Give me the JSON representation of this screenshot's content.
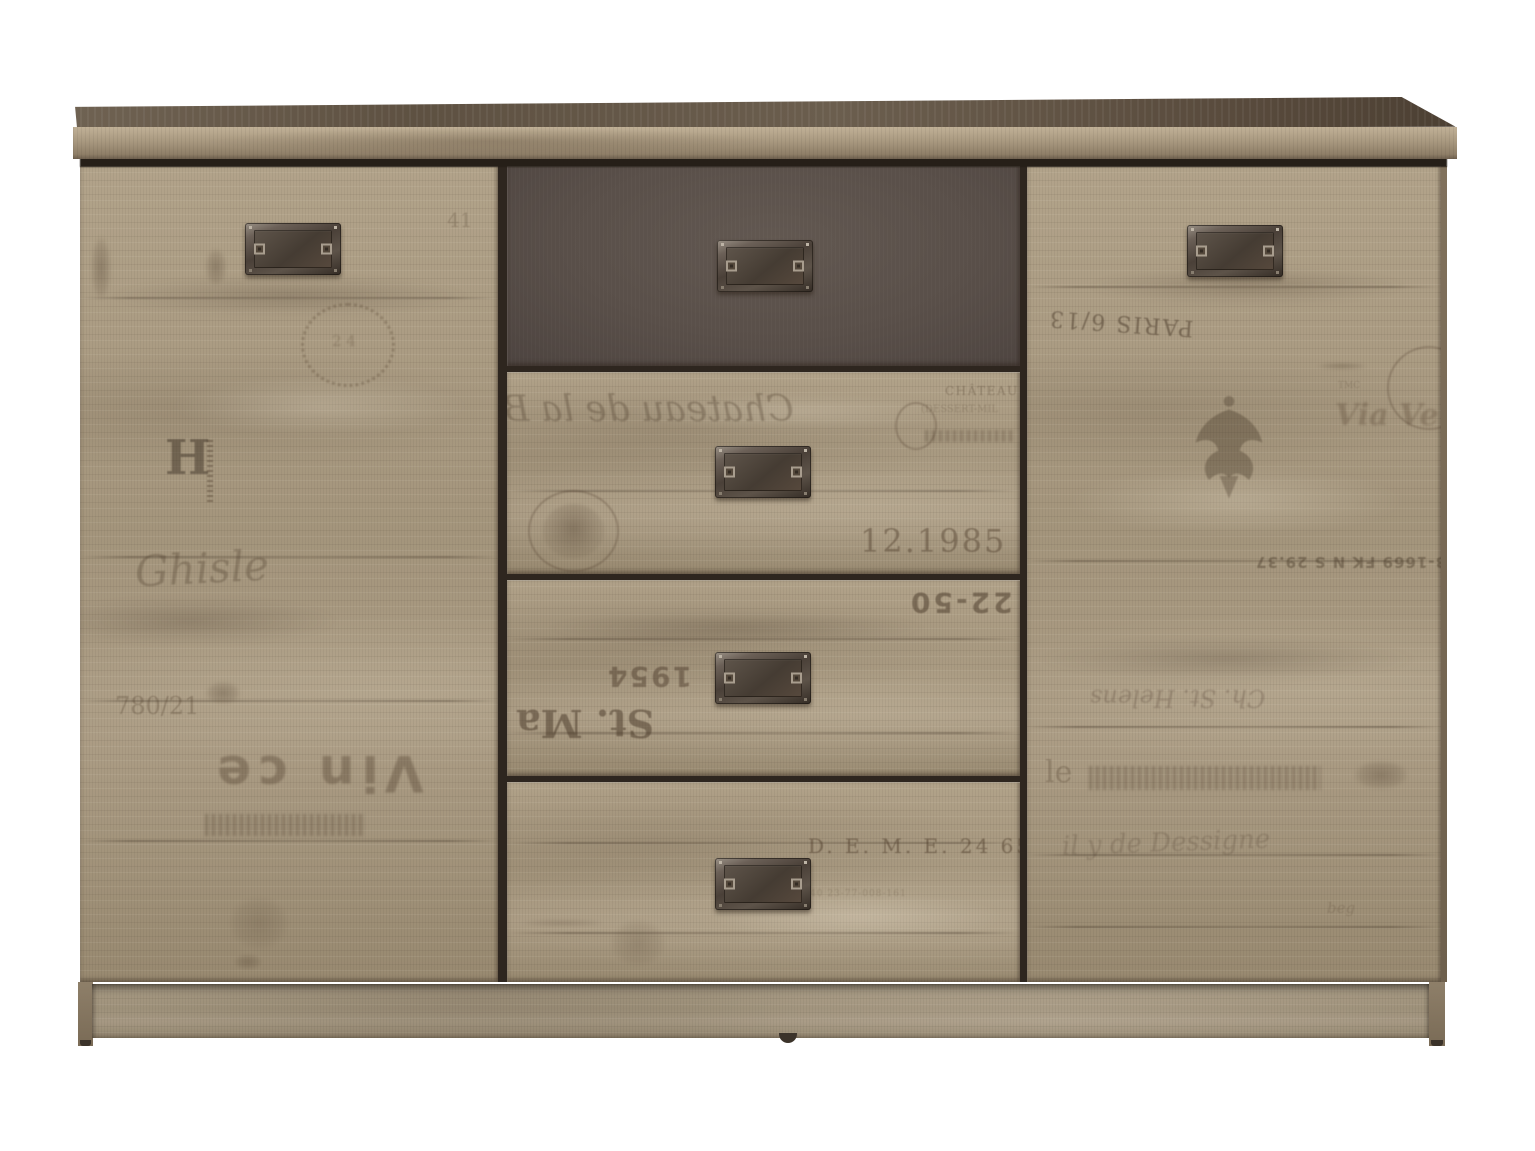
{
  "scene": {
    "description": "Product photo of a rustic vintage-print oak sideboard with two doors, four centre drawers (top drawer graphite grey) and metal label-plate handles, on a plain white background",
    "background_color": "#ffffff"
  },
  "materials": {
    "wood_light": "#b7a88f",
    "wood_mid": "#a5967f",
    "wood_dark": "#7c6c58",
    "top_surface_dark": "#685b4b",
    "graphite_drawer": "#594f4a",
    "gap_shadow": "#2e261f",
    "handle_metal_dark": "#3f362e",
    "handle_metal_light": "#9a9186",
    "print_ink": "#4a3826"
  },
  "structure": {
    "doors": [
      "left",
      "right"
    ],
    "drawer_count": 4,
    "handle_count": 6,
    "top_drawer_finish": "graphite grey",
    "base": "recessed plinth with corner feet and centre glide"
  },
  "prints": {
    "left_door": {
      "mark_41": "41",
      "wreath_center": "2 4",
      "monogram": "H",
      "script": "Ghisle",
      "fraction": "780/21",
      "stencil": "Vin ce"
    },
    "drawer_2": {
      "script": "Chateau de la B",
      "chateau": "CHÂTEAU",
      "chateau_sub": "(DESSERT-MIL",
      "date": "12.1985"
    },
    "drawer_3": {
      "lot": "22-50",
      "year": "1954",
      "saint": "St. Ma"
    },
    "drawer_4": {
      "code": "D. E. M. E.  24 65",
      "small_code": "40 23-77-008-161"
    },
    "right_door": {
      "paris": "PARIS 6/13",
      "tmc": "TMC",
      "via": "Via Ve",
      "serial": "3-1669 FK N S 29.37",
      "script_upper": "Ch. St. Helens",
      "le": "le",
      "script_lower": "il y de Dessigne",
      "beg": "beg"
    }
  }
}
